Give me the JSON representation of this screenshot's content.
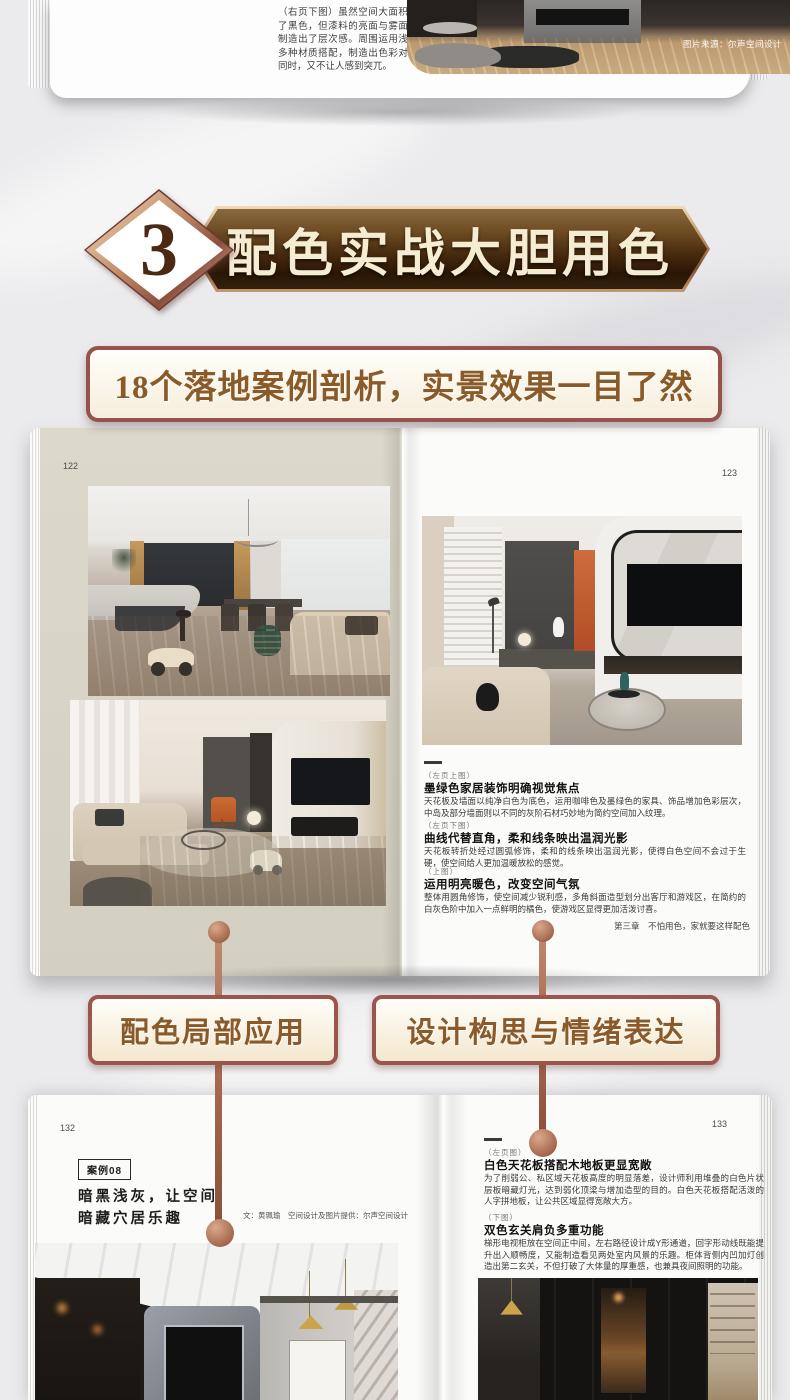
{
  "colors": {
    "banner_dark_brown": "#3a2008",
    "banner_text_cream": "#f6ecd2",
    "frame_maroon": "#96524c",
    "promo_text_brown": "#8a5a28",
    "connector_copper": "#a96a52",
    "left_page_beige": "#d8d4c6",
    "accent_orange": "#c2622f"
  },
  "top_book": {
    "left_text": "（右页下图）虽然空间大面积使用了黑色，但漆料的亮面与雾面变化制造出了层次感。周围运用浅色与多种材质搭配，制造出色彩对比的同时，又不让人感到突兀。",
    "photo_credit": "图片来源：尔声空间设计"
  },
  "section": {
    "number": "3",
    "title": "配色实战大胆用色",
    "subtitle": "18个落地案例剖析，实景效果一目了然"
  },
  "spread1": {
    "left_page_number": "122",
    "right_page_number": "123",
    "captions": [
      {
        "tag": "（左页上图）",
        "heading": "墨绿色家居装饰明确视觉焦点",
        "body": "天花板及墙面以纯净白色为底色，运用咖啡色及墨绿色的家具、饰品增加色彩层次，中岛及部分墙面则以不同的灰阶石材巧妙地为简约空间加入纹理。"
      },
      {
        "tag": "（左页下图）",
        "heading": "曲线代替直角，柔和线条映出温润光影",
        "body": "天花板转折处经过圆弧修饰，柔和的线条映出温润光影，使得白色空间不会过于生硬，使空间给人更加温暖放松的感觉。"
      },
      {
        "tag": "（上图）",
        "heading": "运用明亮暖色，改变空间气氛",
        "body": "整体用圆角修饰，使空间减少锐利感，多角斜面造型划分出客厅和游戏区，在简约的白灰色阶中加入一点鲜明的橘色，使游戏区显得更加活泼讨喜。"
      }
    ],
    "footer": "第三章　不怕用色，家就要这样配色"
  },
  "callouts": {
    "left": "配色局部应用",
    "right": "设计构思与情绪表达"
  },
  "spread2": {
    "left_page_number": "132",
    "right_page_number": "133",
    "case_label": "案例08",
    "case_title_line1": "暗黑浅灰，让空间",
    "case_title_line2": "暗藏穴居乐趣",
    "credit": "文：黄珮瑜　空间设计及图片提供：尔声空间设计",
    "captions": [
      {
        "tag": "（左页图）",
        "heading": "白色天花板搭配木地板更显宽敞",
        "body": "为了削弱公、私区域天花板高度的明显落差，设计师利用堆叠的白色片状层板暗藏灯光，达到弱化顶梁与增加造型的目的。白色天花板搭配活泼的人字拼地板，让公共区域显得宽敞大方。"
      },
      {
        "tag": "（下图）",
        "heading": "双色玄关肩负多重功能",
        "body": "梯形电视柜放在空间正中间，左右路径设计成Y形通道，回字形动线既能提升出入顺畅度，又能制造看见两处室内风景的乐趣。柜体背侧内凹加灯创造出第二玄关，不但打破了大体量的厚重感，也兼具夜间照明的功能。"
      }
    ]
  }
}
